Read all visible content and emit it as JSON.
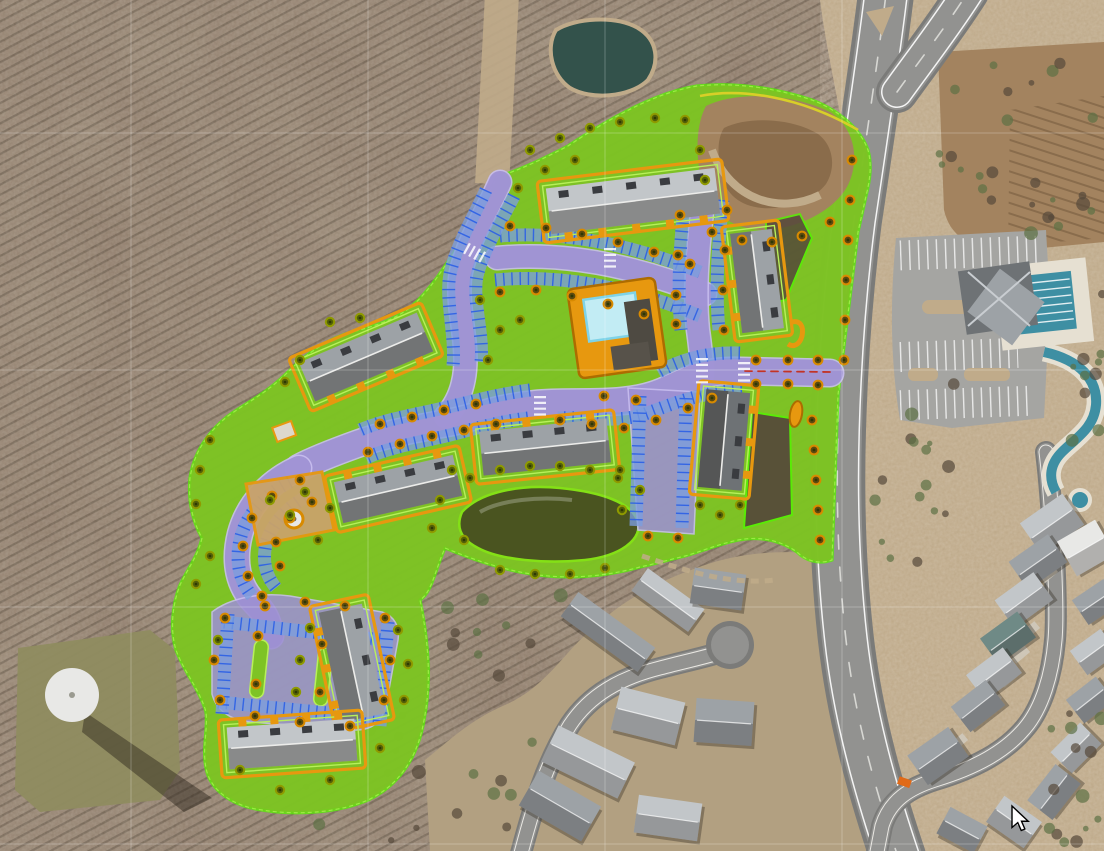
{
  "app": {
    "title": "Aerial site plan overlay map",
    "description": "Satellite imagery with proposed multifamily site plan overlay (landscape, roads, parking, buildings), existing amenity center, ponds, water tower and residential streets",
    "cursor": {
      "x": 1012,
      "y": 806
    }
  },
  "palette": {
    "forestBase": "#8d7a69",
    "forestDark": "#55483a",
    "forestGreen": "#5c7045",
    "fieldTan": "#c0ab8a",
    "groundOlive": "#b2a081",
    "dirtTR": "#a3835f",
    "dirtBowl": "#8a6c4b",
    "clearingOlive": "#8f8c60",
    "asphalt": "#929290",
    "asphaltDark": "#7b7b79",
    "asphaltLight": "#a5a5a2",
    "concrete": "#e6e0d2",
    "white": "#ffffff",
    "overlayGreen": "#7ec325",
    "siteBoundary": "#57ef04",
    "boundaryInner": "#b8f05a",
    "overlayRoad": "#9d90d2",
    "overlayRoadEdge": "#c9bff0",
    "stallFill": "#7b9ede",
    "stallTick": "#2b5fe6",
    "orange": "#e7980f",
    "orangeDark": "#ad6c00",
    "poolWater": "#c2ecf4",
    "poolEdge": "#7ed3e8",
    "lapPool": "#3e8fa3",
    "pondSouth": "#4a5420",
    "pondShore": "#84e016",
    "pondNorth": "#33524b",
    "yellowLine": "#d8cf28",
    "redDash": "#c23326",
    "treeOliveRing": "#8f9a00",
    "treeOliveFill": "#525f08",
    "treeCenter": "#2e3804",
    "treeOrangeRing": "#d88a00",
    "treeOrangeFill": "#5b4a10",
    "roofLight": "#c2c6c9",
    "roofMid": "#9da2a6",
    "roofDark": "#6e7275",
    "roofTeal": "#6f8a86",
    "roofWhite": "#e8e8e6",
    "wall": "#b9ae9c",
    "grid": "rgba(255,255,255,0.25)",
    "shadow": "rgba(40,34,24,0.45)",
    "truckOrange": "#e06a18"
  },
  "scene": {
    "grid": {
      "v": [
        131,
        368,
        605,
        842
      ],
      "h": [
        133,
        370,
        607,
        844
      ]
    },
    "roads": [
      {
        "id": "arterial-road",
        "type": "arterial",
        "d": "M886,-6C878,60 866,140 854,220C845,290 840,360 838,430C836,500 838,570 846,640C854,710 872,780 898,857"
      },
      {
        "id": "arterial-branch-ne",
        "type": "branch",
        "d": "M897,92C920,60 945,28 968,-8"
      },
      {
        "id": "collector-street",
        "type": "street",
        "d": "M876,857L882,826C890,800 910,788 935,780C975,768 1005,752 1025,728C1042,708 1052,675 1055,640C1058,606 1052,500 1046,452"
      },
      {
        "id": "culdesac-street",
        "type": "street",
        "d": "M520,857C535,800 548,760 570,725C590,695 620,678 660,668C690,660 712,656 727,650"
      },
      {
        "id": "site-road-west-ns",
        "type": "overlay",
        "w": 22,
        "d": "M500,182C486,214 468,240 461,272C455,302 468,338 465,370C463,392 455,406 446,416"
      },
      {
        "id": "site-road-north-ew",
        "type": "overlay",
        "w": 22,
        "d": "M497,258C560,252 630,264 705,294"
      },
      {
        "id": "site-road-ne-ns",
        "type": "overlay",
        "w": 22,
        "d": "M704,196C698,244 694,290 698,330C701,352 702,362 702,374"
      },
      {
        "id": "site-main-street",
        "type": "overlay",
        "w": 26,
        "d": "M830,373L740,371C705,370 693,378 664,391C625,408 575,400 535,404C497,408 480,416 452,422C415,429 385,434 357,444C332,453 314,460 299,468"
      },
      {
        "id": "site-loop-west",
        "type": "overlay",
        "w": 24,
        "d": "M299,468C270,481 248,504 240,534C233,562 238,586 255,603C264,612 269,620 271,636"
      }
    ],
    "courts": [
      {
        "id": "parking-court-sw",
        "d": "M212,612C230,598 260,592 290,596L382,612C394,616 400,626 398,640L386,706C382,722 372,730 356,730L250,722C230,720 216,710 212,694Z"
      },
      {
        "id": "parking-court-se",
        "d": "M628,388L700,392L694,534L638,530Z"
      }
    ],
    "parkingBands": [
      "M500,236C560,231 628,243 700,272",
      "M495,280C558,274 628,286 700,316",
      "M685,198C680,244 677,288 681,330",
      "M723,200C718,246 715,288 719,330",
      "M740,353C705,352 680,360 658,372",
      "M742,390C700,392 672,404 645,414C615,424 585,416 558,418",
      "M530,390C498,394 470,402 444,408C412,415 383,420 360,430",
      "M528,418C496,422 470,430 446,436C415,443 388,448 366,458",
      "M486,190C472,220 456,246 450,274C445,300 456,336 453,366",
      "M514,196C500,224 484,248 477,276C472,300 484,334 481,362",
      "M290,482C265,494 246,514 240,540C235,562 240,582 252,596",
      "M312,494C290,504 272,522 266,544C262,562 266,576 276,588",
      "M224,622L382,640",
      "M218,702L378,718",
      "M228,614L222,714",
      "M388,622L380,726",
      "M640,396L636,526",
      "M686,398L682,528"
    ],
    "crosswalks": [
      [
        466,
        248,
        484,
        258
      ],
      [
        610,
        248,
        610,
        268
      ],
      [
        702,
        358,
        702,
        386
      ],
      [
        540,
        396,
        540,
        416
      ],
      [
        744,
        362,
        744,
        384
      ]
    ],
    "centerline": {
      "d": "M830,372L744,371",
      "note": "red dashed entrance centerline"
    },
    "buildings": [
      [
        633,
        201,
        -7,
        170,
        46,
        "roofLight",
        1
      ],
      [
        757,
        281,
        83,
        100,
        42,
        "roofMid",
        1
      ],
      [
        724,
        440,
        95,
        98,
        44,
        "roofDark",
        -1
      ],
      [
        366,
        357,
        -23,
        128,
        42,
        "roofMid",
        1
      ],
      [
        398,
        489,
        -13,
        122,
        42,
        "roofMid",
        -1
      ],
      [
        545,
        447,
        -6,
        128,
        44,
        "roofMid",
        -1
      ],
      [
        352,
        663,
        78,
        112,
        44,
        "roofMid",
        1
      ],
      [
        292,
        744,
        -4,
        128,
        42,
        "roofLight",
        -1
      ]
    ],
    "houses": [
      [
        608,
        632,
        36,
        95,
        30,
        "roofMid"
      ],
      [
        668,
        600,
        36,
        70,
        28,
        "roofLight"
      ],
      [
        718,
        589,
        8,
        52,
        36,
        "roofMid"
      ],
      [
        648,
        716,
        14,
        66,
        44,
        "roofLight"
      ],
      [
        724,
        722,
        4,
        58,
        44,
        "roofMid"
      ],
      [
        588,
        762,
        26,
        85,
        40,
        "roofLight"
      ],
      [
        560,
        806,
        30,
        72,
        40,
        "roofMid"
      ],
      [
        668,
        818,
        8,
        64,
        38,
        "roofLight"
      ],
      [
        1052,
        524,
        -35,
        52,
        38,
        "roofLight"
      ],
      [
        1038,
        562,
        -35,
        48,
        34,
        "roofMid"
      ],
      [
        1024,
        600,
        -36,
        48,
        34,
        "roofLight"
      ],
      [
        1008,
        638,
        -36,
        46,
        32,
        "roofTeal"
      ],
      [
        994,
        674,
        -37,
        46,
        32,
        "roofLight"
      ],
      [
        978,
        706,
        -38,
        44,
        32,
        "roofMid"
      ],
      [
        1086,
        548,
        -30,
        44,
        40,
        "roofWhite"
      ],
      [
        1096,
        602,
        -34,
        38,
        30,
        "roofMid"
      ],
      [
        1094,
        652,
        -36,
        38,
        30,
        "roofLight"
      ],
      [
        1090,
        700,
        -38,
        38,
        30,
        "roofMid"
      ],
      [
        1076,
        748,
        -45,
        42,
        30,
        "roofLight"
      ],
      [
        1054,
        792,
        -52,
        46,
        32,
        "roofMid"
      ],
      [
        1014,
        822,
        35,
        46,
        32,
        "roofLight"
      ],
      [
        962,
        830,
        28,
        42,
        30,
        "roofMid"
      ],
      [
        938,
        756,
        -35,
        50,
        36,
        "roofMid"
      ]
    ],
    "treesStreet": [
      [
        368,
        452
      ],
      [
        400,
        444
      ],
      [
        432,
        436
      ],
      [
        464,
        430
      ],
      [
        496,
        424
      ],
      [
        560,
        420
      ],
      [
        592,
        424
      ],
      [
        624,
        428
      ],
      [
        656,
        420
      ],
      [
        688,
        408
      ],
      [
        712,
        398
      ],
      [
        380,
        424
      ],
      [
        412,
        417
      ],
      [
        444,
        410
      ],
      [
        476,
        404
      ],
      [
        604,
        396
      ],
      [
        636,
        400
      ],
      [
        756,
        360
      ],
      [
        788,
        360
      ],
      [
        756,
        384
      ],
      [
        788,
        384
      ],
      [
        818,
        360
      ],
      [
        818,
        385
      ],
      [
        727,
        210
      ],
      [
        725,
        250
      ],
      [
        723,
        290
      ],
      [
        724,
        330
      ],
      [
        680,
        215
      ],
      [
        678,
        255
      ],
      [
        676,
        295
      ],
      [
        510,
        226
      ],
      [
        546,
        228
      ],
      [
        582,
        234
      ],
      [
        618,
        242
      ],
      [
        654,
        252
      ],
      [
        690,
        264
      ],
      [
        500,
        292
      ],
      [
        536,
        290
      ],
      [
        572,
        296
      ],
      [
        608,
        304
      ],
      [
        644,
        314
      ],
      [
        676,
        324
      ],
      [
        300,
        480
      ],
      [
        272,
        496
      ],
      [
        252,
        518
      ],
      [
        243,
        546
      ],
      [
        248,
        576
      ],
      [
        262,
        596
      ],
      [
        312,
        502
      ],
      [
        290,
        518
      ],
      [
        276,
        542
      ],
      [
        280,
        566
      ],
      [
        225,
        618
      ],
      [
        265,
        606
      ],
      [
        305,
        602
      ],
      [
        345,
        606
      ],
      [
        385,
        618
      ],
      [
        390,
        660
      ],
      [
        384,
        700
      ],
      [
        350,
        726
      ],
      [
        300,
        722
      ],
      [
        255,
        716
      ],
      [
        220,
        700
      ],
      [
        214,
        660
      ],
      [
        258,
        636
      ],
      [
        256,
        684
      ],
      [
        322,
        644
      ],
      [
        320,
        692
      ],
      [
        648,
        536
      ],
      [
        678,
        538
      ],
      [
        712,
        232
      ],
      [
        742,
        240
      ],
      [
        772,
        242
      ],
      [
        802,
        236
      ],
      [
        830,
        222
      ],
      [
        852,
        160
      ],
      [
        850,
        200
      ],
      [
        848,
        240
      ],
      [
        846,
        280
      ],
      [
        845,
        320
      ],
      [
        844,
        360
      ],
      [
        812,
        420
      ],
      [
        814,
        450
      ],
      [
        816,
        480
      ],
      [
        818,
        510
      ],
      [
        820,
        540
      ]
    ],
    "treesOlive": [
      [
        530,
        150
      ],
      [
        560,
        138
      ],
      [
        590,
        128
      ],
      [
        620,
        122
      ],
      [
        655,
        118
      ],
      [
        685,
        120
      ],
      [
        545,
        170
      ],
      [
        575,
        160
      ],
      [
        518,
        188
      ],
      [
        700,
        150
      ],
      [
        705,
        180
      ],
      [
        480,
        300
      ],
      [
        500,
        330
      ],
      [
        488,
        360
      ],
      [
        520,
        320
      ],
      [
        452,
        470
      ],
      [
        440,
        500
      ],
      [
        432,
        528
      ],
      [
        464,
        540
      ],
      [
        470,
        478
      ],
      [
        500,
        470
      ],
      [
        530,
        466
      ],
      [
        560,
        466
      ],
      [
        590,
        470
      ],
      [
        618,
        478
      ],
      [
        500,
        570
      ],
      [
        535,
        574
      ],
      [
        570,
        574
      ],
      [
        605,
        568
      ],
      [
        620,
        470
      ],
      [
        640,
        490
      ],
      [
        622,
        510
      ],
      [
        700,
        505
      ],
      [
        720,
        515
      ],
      [
        740,
        505
      ],
      [
        310,
        628
      ],
      [
        300,
        660
      ],
      [
        296,
        692
      ],
      [
        398,
        630
      ],
      [
        408,
        664
      ],
      [
        404,
        700
      ],
      [
        380,
        748
      ],
      [
        330,
        780
      ],
      [
        280,
        790
      ],
      [
        240,
        770
      ],
      [
        218,
        640
      ],
      [
        210,
        440
      ],
      [
        200,
        470
      ],
      [
        196,
        504
      ],
      [
        210,
        556
      ],
      [
        196,
        584
      ],
      [
        300,
        360
      ],
      [
        285,
        382
      ],
      [
        330,
        322
      ],
      [
        360,
        318
      ],
      [
        318,
        540
      ],
      [
        330,
        508
      ],
      [
        270,
        500
      ],
      [
        290,
        515
      ],
      [
        305,
        492
      ]
    ],
    "driveways": [
      [
        958,
        742
      ],
      [
        975,
        722
      ],
      [
        992,
        700
      ],
      [
        1008,
        678
      ],
      [
        1020,
        654
      ],
      [
        1030,
        630
      ],
      [
        1040,
        602
      ],
      [
        1048,
        574
      ]
    ]
  }
}
